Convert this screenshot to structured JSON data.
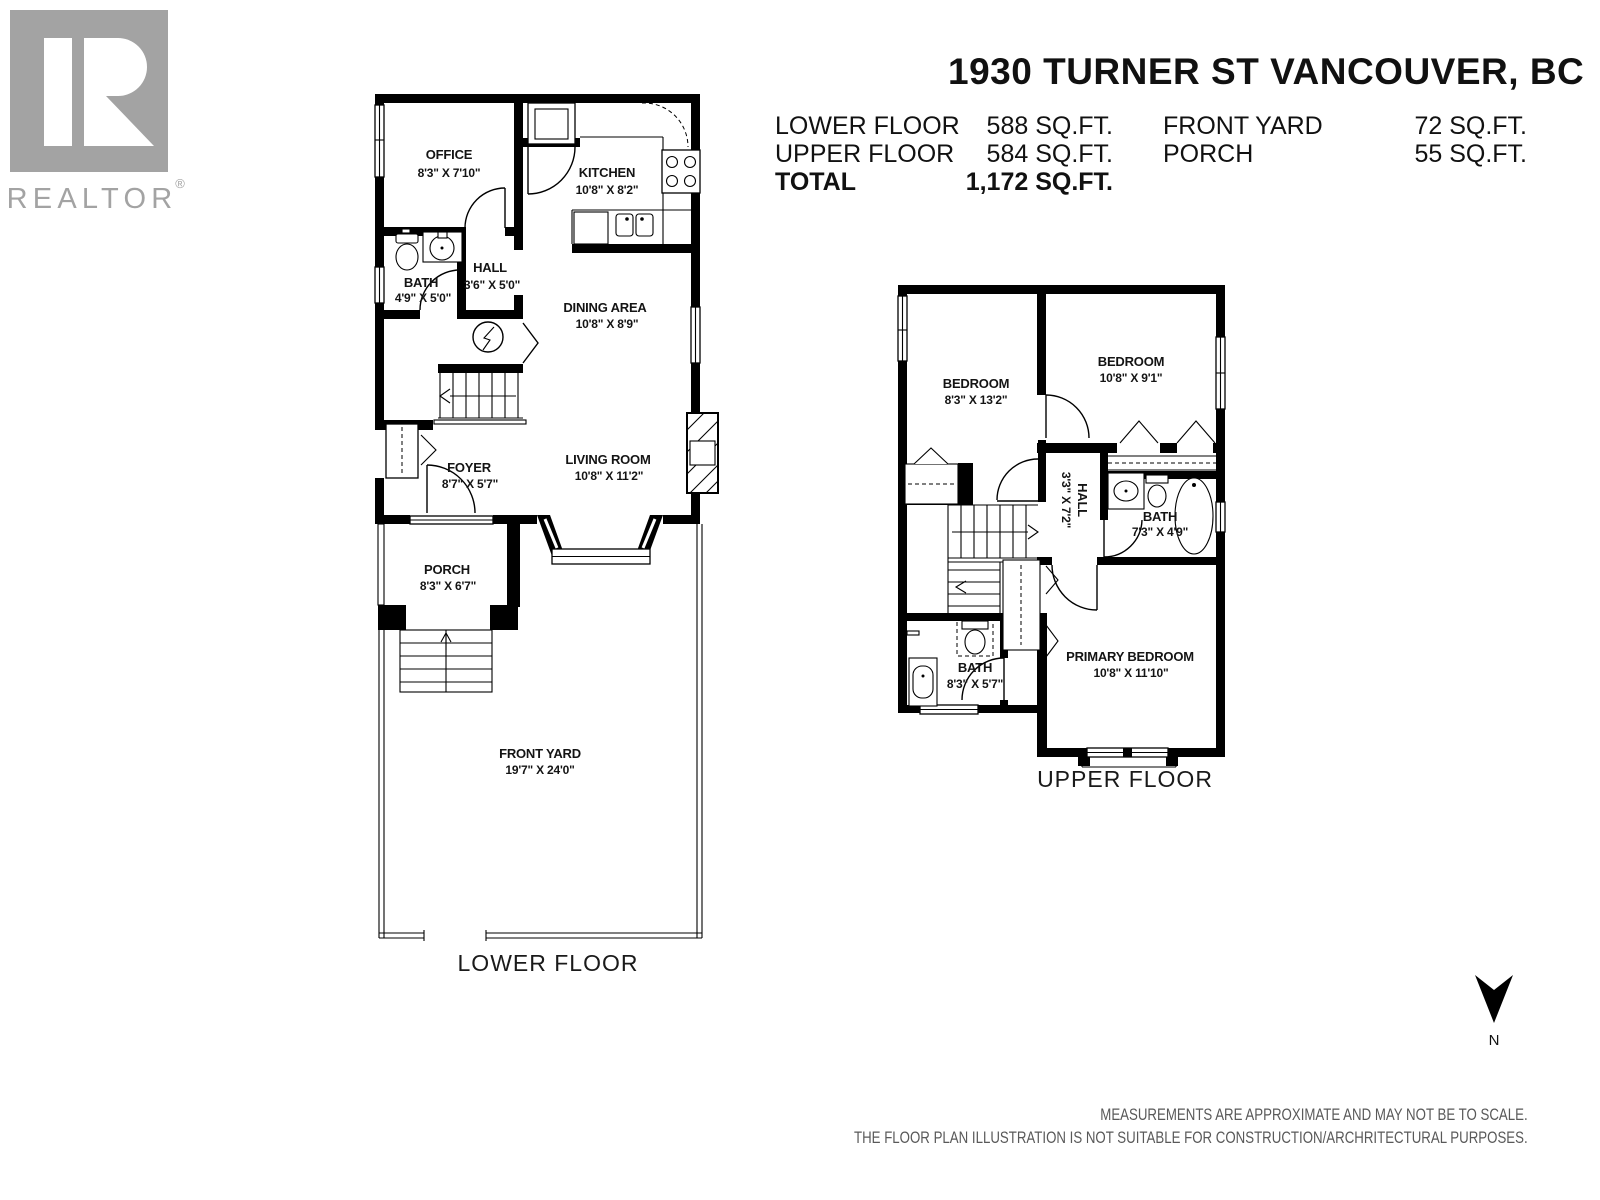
{
  "logo": {
    "brand": "REALTOR",
    "registered": "®"
  },
  "header": {
    "title": "1930 TURNER ST VANCOUVER, BC",
    "stats_left": [
      {
        "label": "LOWER FLOOR",
        "value": "588 SQ.FT."
      },
      {
        "label": "UPPER FLOOR",
        "value": "584 SQ.FT."
      },
      {
        "label": "TOTAL",
        "value": "1,172 SQ.FT."
      }
    ],
    "stats_right": [
      {
        "label": "FRONT YARD",
        "value": "72 SQ.FT."
      },
      {
        "label": "PORCH",
        "value": "55 SQ.FT."
      }
    ]
  },
  "lower_floor": {
    "caption": "LOWER FLOOR",
    "rooms": {
      "office": {
        "name": "OFFICE",
        "dims": "8'3\" X 7'10\""
      },
      "kitchen": {
        "name": "KITCHEN",
        "dims": "10'8\" X 8'2\""
      },
      "bath": {
        "name": "BATH",
        "dims": "4'9\" X 5'0\""
      },
      "hall": {
        "name": "HALL",
        "dims": "3'6\" X 5'0\""
      },
      "dining": {
        "name": "DINING AREA",
        "dims": "10'8\" X 8'9\""
      },
      "living": {
        "name": "LIVING ROOM",
        "dims": "10'8\" X 11'2\""
      },
      "foyer": {
        "name": "FOYER",
        "dims": "8'7\" X 5'7\""
      },
      "porch": {
        "name": "PORCH",
        "dims": "8'3\" X 6'7\""
      },
      "front_yard": {
        "name": "FRONT YARD",
        "dims": "19'7\" X 24'0\""
      }
    }
  },
  "upper_floor": {
    "caption": "UPPER FLOOR",
    "rooms": {
      "bedroom_left": {
        "name": "BEDROOM",
        "dims": "8'3\" X 13'2\""
      },
      "bedroom_right": {
        "name": "BEDROOM",
        "dims": "10'8\" X 9'1\""
      },
      "hall": {
        "name": "HALL",
        "dims": "3'3\" X 7'2\""
      },
      "bath_upper": {
        "name": "BATH",
        "dims": "7'3\" X 4'9\""
      },
      "bath_lower": {
        "name": "BATH",
        "dims": "8'3\" X 5'7\""
      },
      "primary": {
        "name": "PRIMARY BEDROOM",
        "dims": "10'8\" X 11'10\""
      }
    }
  },
  "compass": {
    "label": "N"
  },
  "disclaimer": {
    "line1": "MEASUREMENTS ARE APPROXIMATE AND MAY NOT BE TO SCALE.",
    "line2": "THE FLOOR PLAN ILLUSTRATION IS NOT SUITABLE FOR CONSTRUCTION/ARCHRITECTURAL PURPOSES."
  },
  "colors": {
    "wall": "#000000",
    "logo_gray": "#a3a3a3",
    "text": "#111111",
    "disclaimer_gray": "#595959"
  }
}
